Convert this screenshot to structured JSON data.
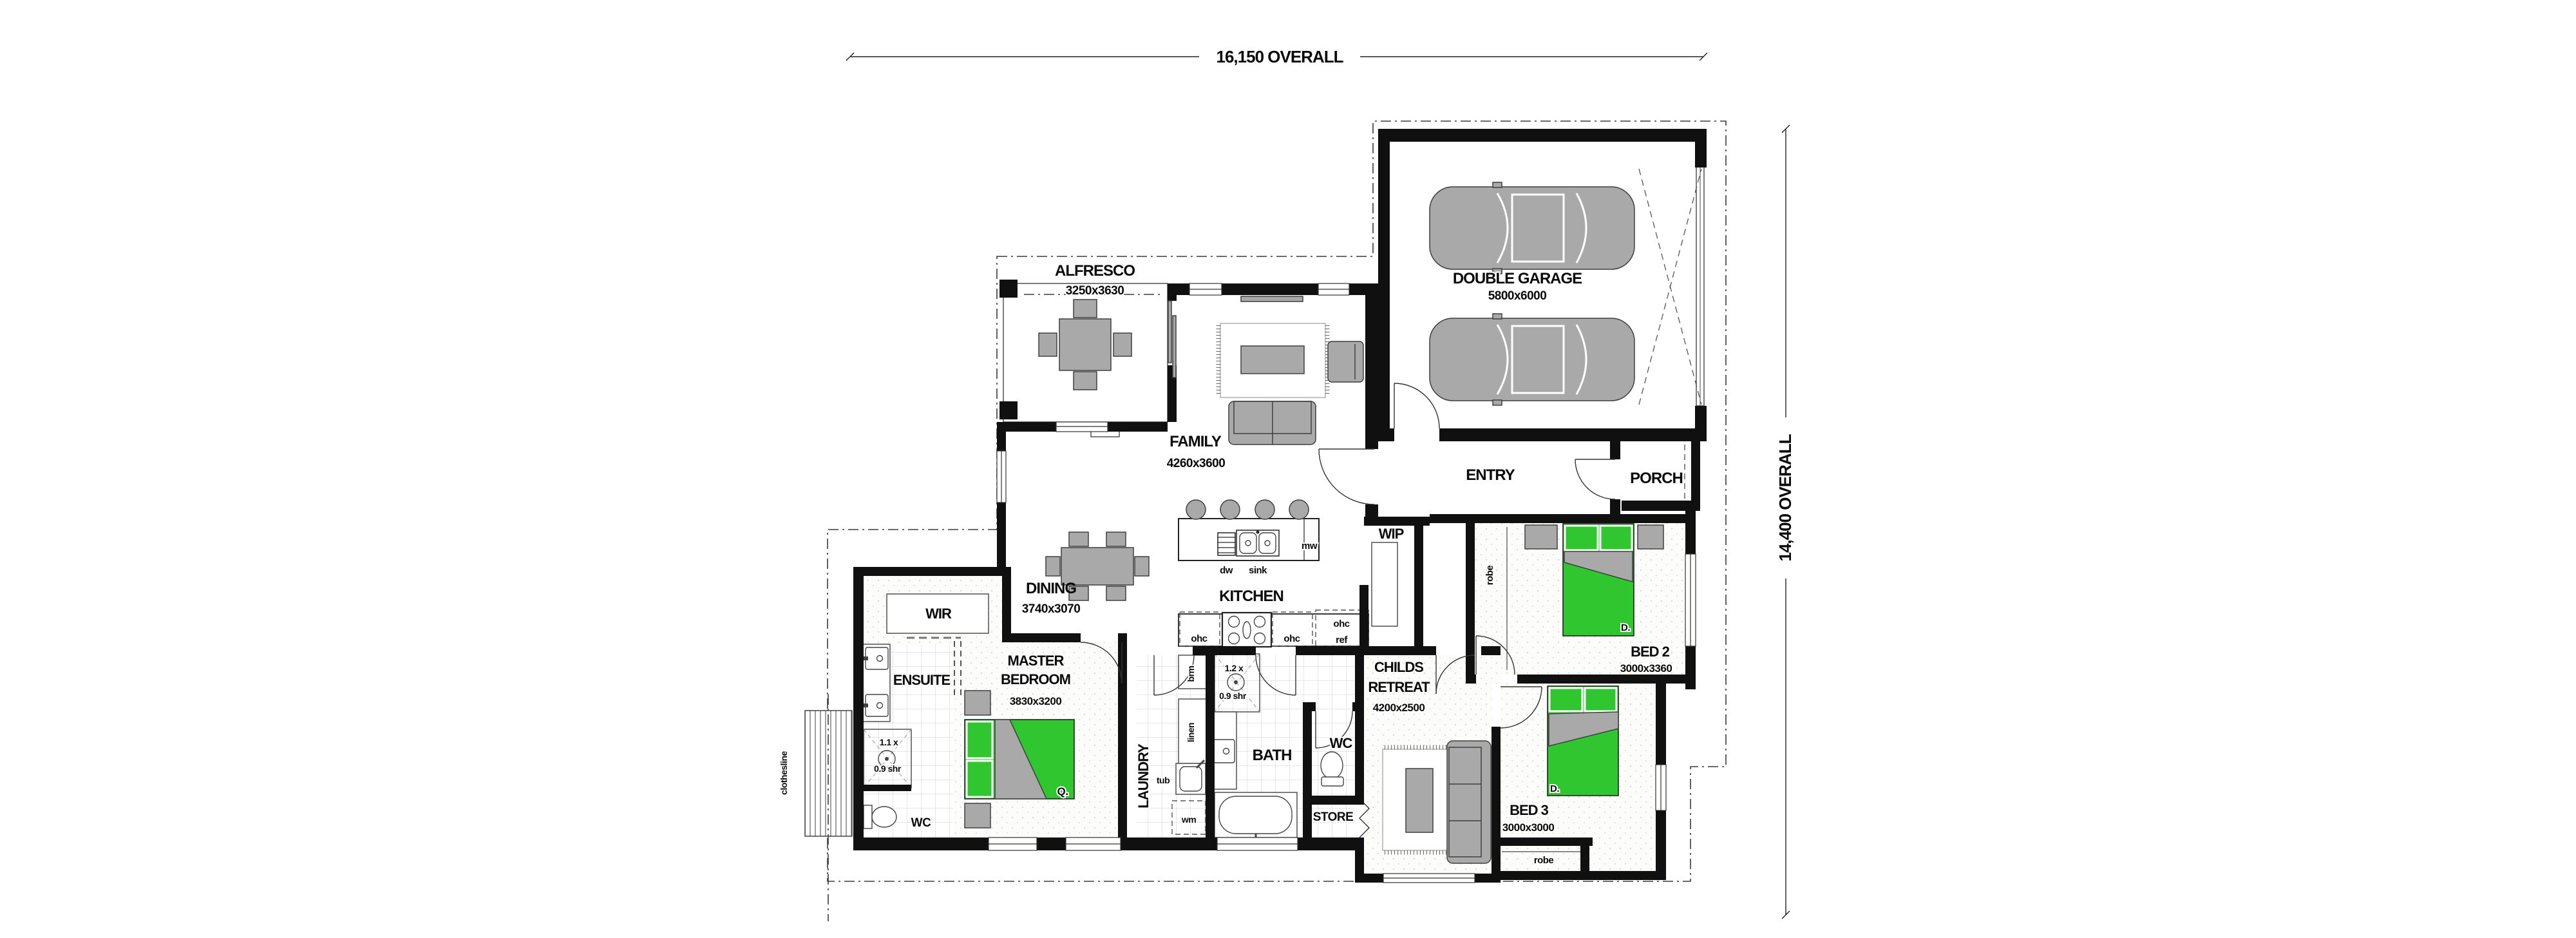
{
  "title": "Single storey house floor plan",
  "colors": {
    "bed_green": "#2fc62f",
    "furniture_gray": "#a9a9a9",
    "wall_black": "#101010"
  },
  "dimensions": {
    "overall_width": "16,150 OVERALL",
    "overall_height": "14,400 OVERALL"
  },
  "rooms": {
    "alfresco": {
      "name": "ALFRESCO",
      "dims": "3250x3630"
    },
    "double_garage": {
      "name": "DOUBLE GARAGE",
      "dims": "5800x6000"
    },
    "family": {
      "name": "FAMILY",
      "dims": "4260x3600"
    },
    "dining": {
      "name": "DINING",
      "dims": "3740x3070"
    },
    "kitchen": {
      "name": "KITCHEN"
    },
    "entry": {
      "name": "ENTRY"
    },
    "porch": {
      "name": "PORCH"
    },
    "wip": {
      "name": "WIP"
    },
    "wir": {
      "name": "WIR"
    },
    "master": {
      "name_line1": "MASTER",
      "name_line2": "BEDROOM",
      "dims": "3830x3200"
    },
    "ensuite": {
      "name": "ENSUITE"
    },
    "wc_ensuite": {
      "name": "WC"
    },
    "laundry": {
      "name": "LAUNDRY"
    },
    "bath": {
      "name": "BATH"
    },
    "wc_main": {
      "name": "WC"
    },
    "store": {
      "name": "STORE"
    },
    "childs_retreat": {
      "name_line1": "CHILDS",
      "name_line2": "RETREAT",
      "dims": "4200x2500"
    },
    "bed2": {
      "name": "BED 2",
      "dims": "3000x3360"
    },
    "bed3": {
      "name": "BED 3",
      "dims": "3000x3000"
    },
    "robe_bed2": {
      "name": "robe"
    },
    "robe_bed3": {
      "name": "robe"
    }
  },
  "fixtures": {
    "dw": "dw",
    "sink": "sink",
    "mw": "mw",
    "ohc_1": "ohc",
    "ohc_2": "ohc",
    "ohc_3": "ohc",
    "ref": "ref",
    "brm": "brm",
    "linen": "linen",
    "tub": "tub",
    "wm": "wm",
    "shower_ensuite_1": "1.1 x",
    "shower_ensuite_2": "0.9 shr",
    "shower_bath_1": "1.2 x",
    "shower_bath_2": "0.9 shr",
    "bed_master_size": "Q.",
    "bed2_size": "D.",
    "bed3_size": "D.",
    "clothesline": "clothesline"
  }
}
